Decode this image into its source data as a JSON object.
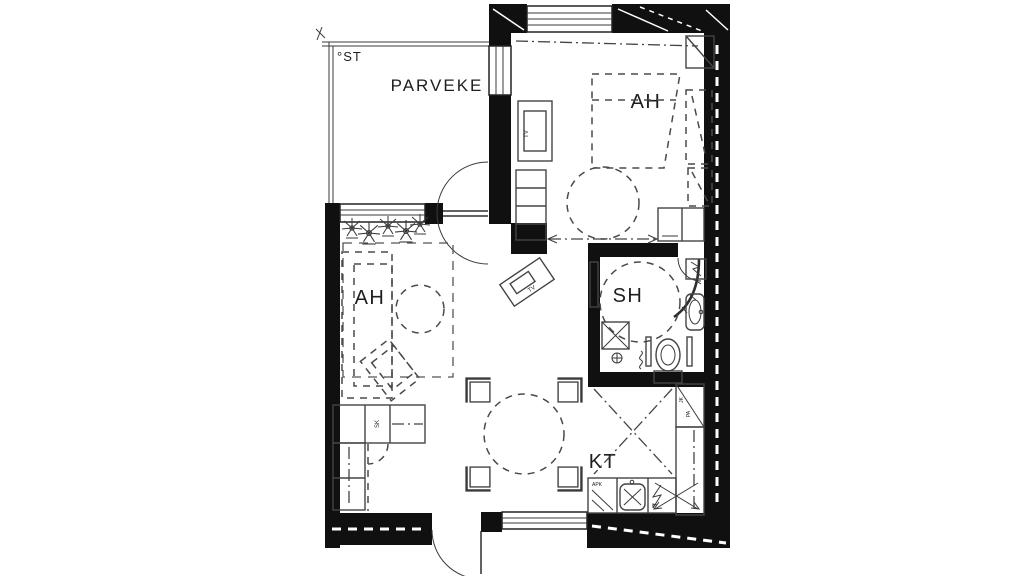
{
  "colors": {
    "background": "#ffffff",
    "wall": "#101010",
    "ink": "#2e2e2e",
    "furniture_line": "#4a4a4a"
  },
  "labels": {
    "balcony": "PARVEKE",
    "balcony_st": "°ST",
    "bedroom": "AH",
    "living_room": "AH",
    "shower_room": "SH",
    "kitchen": "KT",
    "tv_bedroom": "TV",
    "tv_desk": "TV",
    "cleaning_closet": "SK",
    "dishwasher": "APK",
    "fridge_top": "JK",
    "fridge_bottom": "PA"
  }
}
